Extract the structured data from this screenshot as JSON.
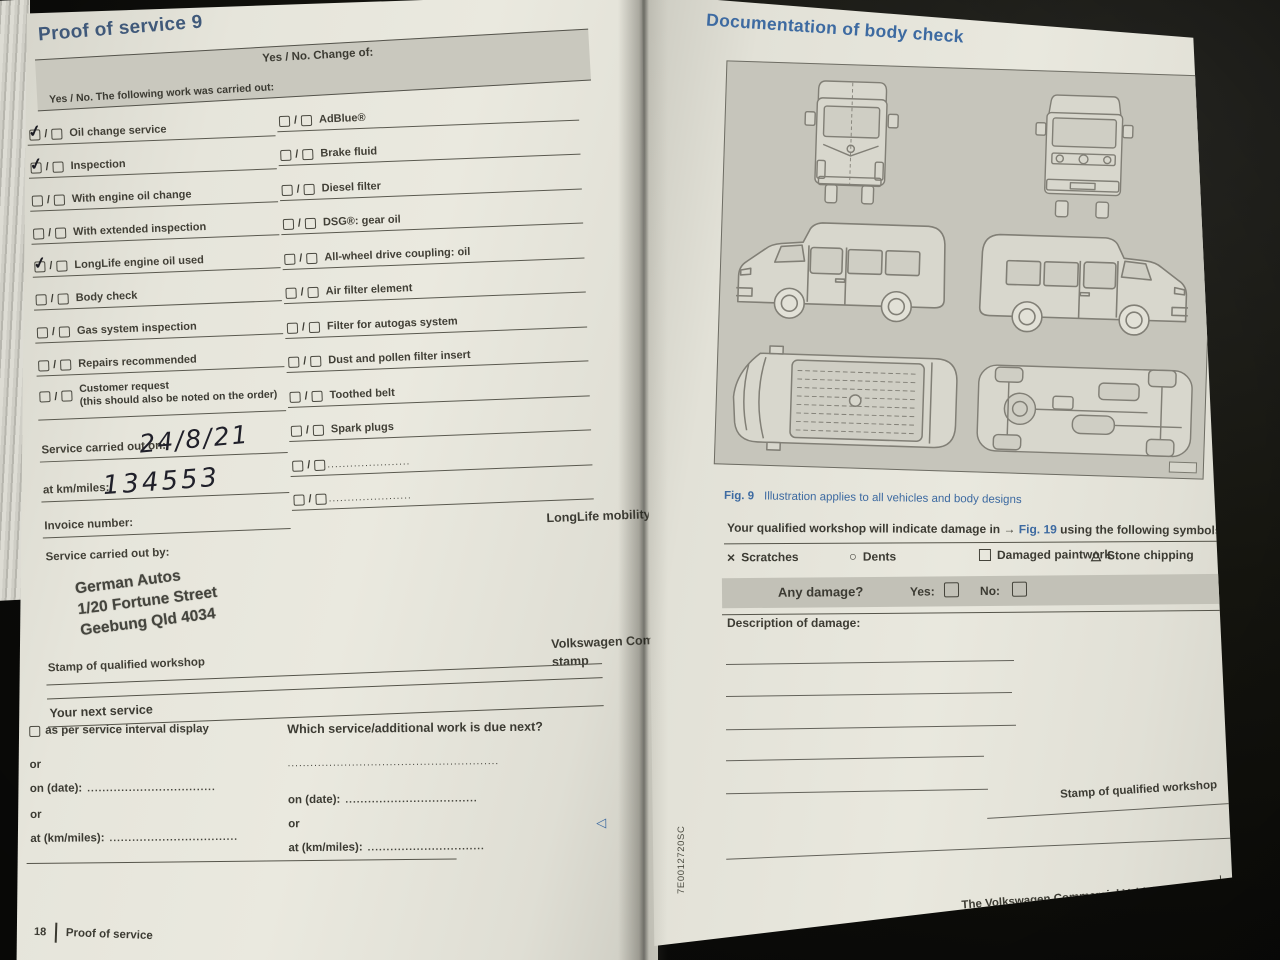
{
  "colors": {
    "accent_blue": "#3d6aa1",
    "page": "#e8e7dd",
    "panel_gray": "#c6c5bb",
    "bar_gray": "#c2c1b7",
    "ink": "#3c3b33"
  },
  "left_page": {
    "title": "Proof of service 9",
    "checkbox_separator": "/",
    "table_header_left": "Yes / No. The following work was carried out:",
    "table_header_right": "Yes / No. Change of:",
    "work_items": [
      {
        "label": "Oil change service",
        "checked": true
      },
      {
        "label": "Inspection",
        "checked": true
      },
      {
        "label": "With engine oil change",
        "checked": false
      },
      {
        "label": "With extended inspection",
        "checked": false
      },
      {
        "label": "LongLife engine oil used",
        "checked": true
      },
      {
        "label": "Body check",
        "checked": false
      },
      {
        "label": "Gas system inspection",
        "checked": false
      },
      {
        "label": "Repairs recommended",
        "checked": false
      },
      {
        "label": "Customer request",
        "sublabel": "(this should also be noted on the order)",
        "checked": false
      }
    ],
    "change_items": [
      "AdBlue®",
      "Brake fluid",
      "Diesel filter",
      "DSG®: gear oil",
      "All-wheel drive coupling: oil",
      "Air filter element",
      "Filter for autogas system",
      "Dust and pollen filter insert",
      "Toothed belt",
      "Spark plugs",
      "......................",
      "......................"
    ],
    "service_date_label": "Service carried out on:",
    "service_date_value": "24/8/21",
    "km_label": "at km/miles:",
    "km_value": "134553",
    "invoice_label": "Invoice number:",
    "carried_out_by_label": "Service carried out by:",
    "workshop_stamp_lines": [
      "German Autos",
      "1/20 Fortune Street",
      "Geebung  Qld 4034"
    ],
    "stamp_caption": "Stamp of qualified workshop",
    "longlife_label": "LongLife mobility guarantee:",
    "dealer_stamp_caption": "Volkswagen Commercial Vehicles dealership stamp",
    "next_service": {
      "heading": "Your next service",
      "interval_option": "as per service interval display",
      "or_1": "or",
      "on_date_label": "on (date):",
      "on_date_dots": "..................................",
      "or_2": "or",
      "at_km_label": "at (km/miles):",
      "at_km_dots": "..................................",
      "question": "Which service/additional work is due next?",
      "question_dots": "........................................................",
      "right_on_date_label": "on (date):",
      "right_on_date_dots": "...................................",
      "right_or": "or",
      "right_at_km_label": "at (km/miles):",
      "right_at_km_dots": "..............................."
    },
    "footer_page_number": "18",
    "footer_label": "Proof of service",
    "end_marker": "◁"
  },
  "right_page": {
    "title": "Documentation of body check",
    "fig_label": "Fig. 9",
    "fig_caption": "Illustration applies to all vehicles and body designs",
    "indicate_prefix": "Your qualified workshop will indicate damage in → ",
    "indicate_fig_ref": "Fig. 19",
    "indicate_suffix": " using the following symbols:",
    "symbols": [
      {
        "glyph": "×",
        "label": "Scratches"
      },
      {
        "glyph": "○",
        "label": "Dents"
      },
      {
        "glyph": "",
        "label": "Damaged paintwork"
      },
      {
        "glyph": "△",
        "label": "Stone chipping"
      }
    ],
    "any_damage_label": "Any damage?",
    "yes_label": "Yes:",
    "no_label": "No:",
    "description_label": "Description of damage:",
    "stamp_caption": "Stamp of qualified workshop",
    "spine_code": "7E0012720SC",
    "footer_text": "The Volkswagen Commercial Vehicles service",
    "footer_page_number": "19",
    "end_marker": "◁"
  }
}
